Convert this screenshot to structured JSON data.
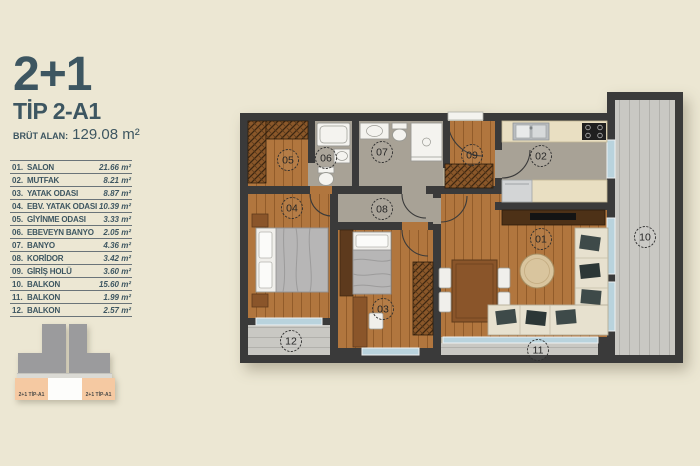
{
  "header": {
    "title": "2+1",
    "type_label": "TİP 2-A1",
    "gross_area_label": "BRÜT ALAN:",
    "gross_area_value": "129.08 m²"
  },
  "legend": {
    "rows": [
      {
        "no": "01.",
        "name": "SALON",
        "area": "21.66 m²"
      },
      {
        "no": "02.",
        "name": "MUTFAK",
        "area": "8.21 m²"
      },
      {
        "no": "03.",
        "name": "YATAK ODASI",
        "area": "8.87 m²"
      },
      {
        "no": "04.",
        "name": "EBV. YATAK ODASI",
        "area": "10.39 m²"
      },
      {
        "no": "05.",
        "name": "GİYİNME ODASI",
        "area": "3.33 m²"
      },
      {
        "no": "06.",
        "name": "EBEVEYN BANYO",
        "area": "2.05 m²"
      },
      {
        "no": "07.",
        "name": "BANYO",
        "area": "4.36 m²"
      },
      {
        "no": "08.",
        "name": "KORİDOR",
        "area": "3.42 m²"
      },
      {
        "no": "09.",
        "name": "GİRİŞ HOLÜ",
        "area": "3.60 m²"
      },
      {
        "no": "10.",
        "name": "BALKON",
        "area": "15.60 m²"
      },
      {
        "no": "11.",
        "name": "BALKON",
        "area": "1.99 m²"
      },
      {
        "no": "12.",
        "name": "BALKON",
        "area": "2.57 m²"
      }
    ]
  },
  "plan": {
    "numbers": [
      "01",
      "02",
      "03",
      "04",
      "05",
      "06",
      "07",
      "08",
      "09",
      "10",
      "11",
      "12"
    ]
  },
  "keyplan": {
    "left_unit": "2+1 TİP-A1",
    "right_unit": "2+1 TİP-A1"
  },
  "colors": {
    "background": "#ece7d3",
    "wall": "#3a3a3a",
    "wood_floor": "#b1763e",
    "tile_floor": "#a8a296",
    "balcony_floor": "#c9c8c3",
    "counter": "#e9dfc2",
    "window": "#b9d3dd",
    "accent_text": "#3d5661",
    "keyplan_gray": "#9b9b9d",
    "keyplan_salmon": "#f5c9a2"
  }
}
